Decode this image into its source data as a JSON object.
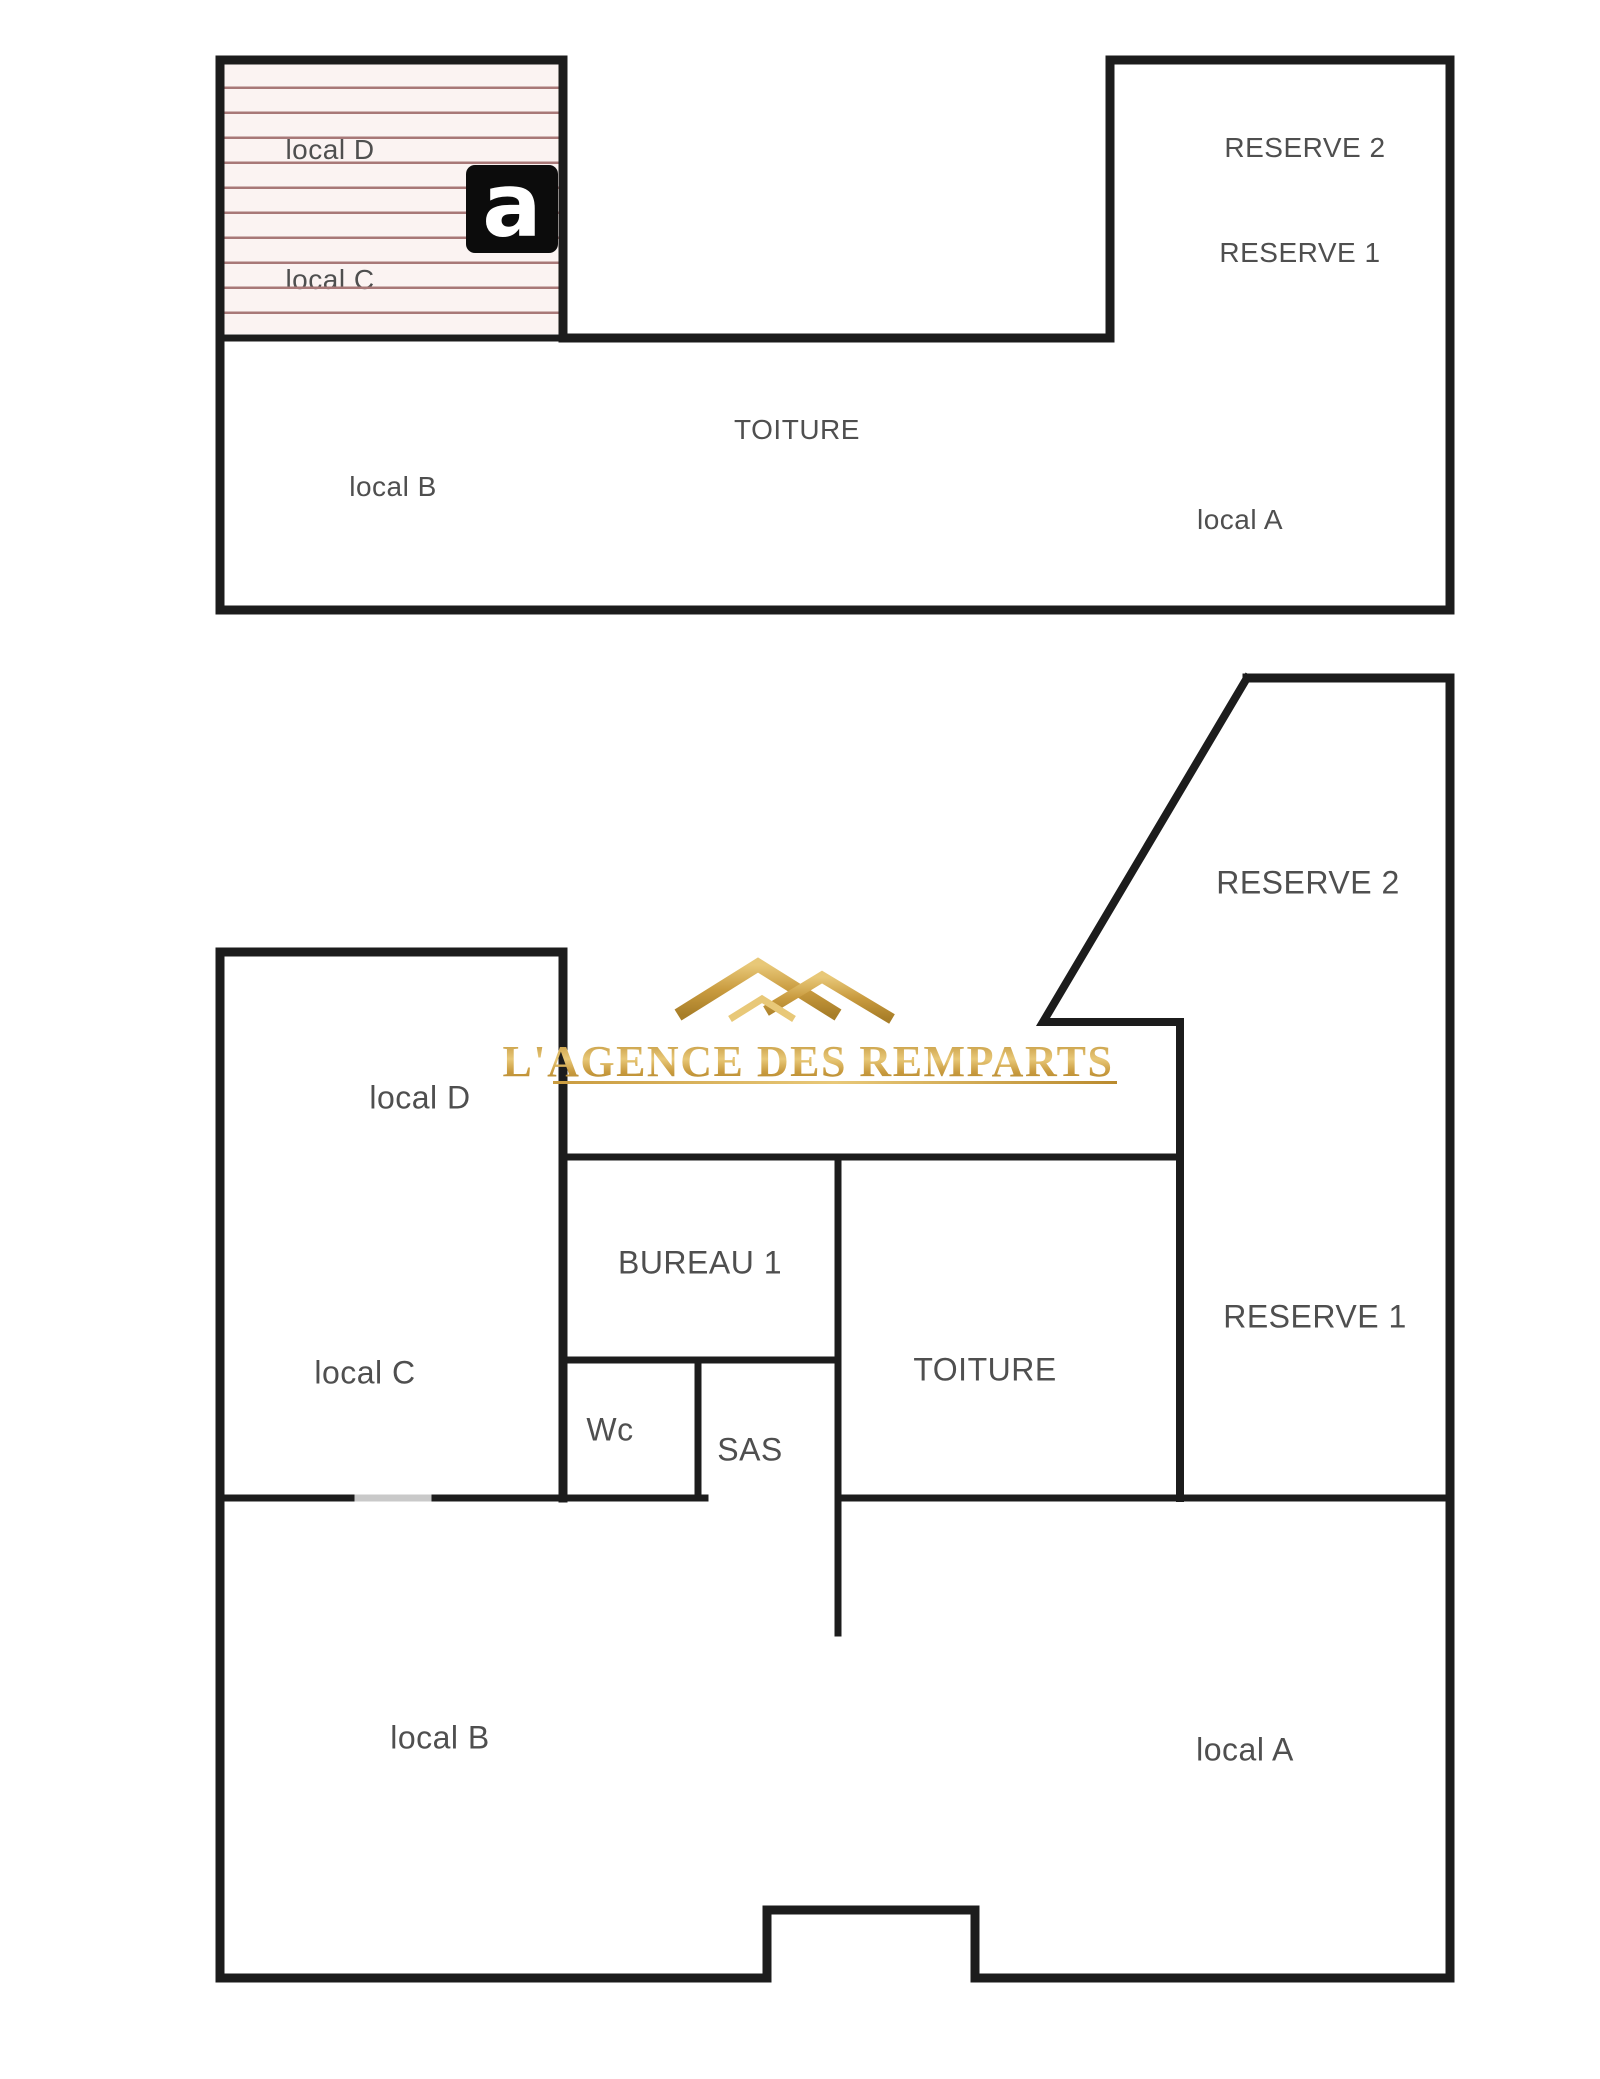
{
  "colors": {
    "wall": "#1c1c1c",
    "label_text": "#4f4f4f",
    "hatch_line": "#a87878",
    "hatch_background": "#fbf3f2",
    "door_gap": "#c9c9c9",
    "watermark_gold": "#c99b3f",
    "logo_background": "#0c0c0c",
    "logo_letter": "#ffffff"
  },
  "logo": {
    "letter": "a",
    "x": 466,
    "y": 165,
    "w": 92,
    "h": 88
  },
  "upper_plan": {
    "outline": {
      "points": [
        [
          220,
          60
        ],
        [
          563,
          60
        ],
        [
          563,
          338
        ],
        [
          1110,
          338
        ],
        [
          1110,
          60
        ],
        [
          1450,
          60
        ],
        [
          1450,
          610
        ],
        [
          220,
          610
        ],
        [
          220,
          60
        ]
      ],
      "w": 9
    },
    "inner_walls": [
      {
        "points": [
          [
            220,
            338
          ],
          [
            563,
            338
          ]
        ],
        "w": 7
      }
    ],
    "hatch_area": {
      "x": 224,
      "y": 64,
      "w": 335,
      "h": 270
    },
    "rooms": [
      {
        "id": "local-d",
        "label": "local D",
        "x": 330,
        "y": 150
      },
      {
        "id": "local-c",
        "label": "local C",
        "x": 330,
        "y": 280
      },
      {
        "id": "reserve-2",
        "label": "RESERVE 2",
        "x": 1305,
        "y": 148
      },
      {
        "id": "reserve-1",
        "label": "RESERVE 1",
        "x": 1300,
        "y": 253
      },
      {
        "id": "toiture",
        "label": "TOITURE",
        "x": 797,
        "y": 430
      },
      {
        "id": "local-b",
        "label": "local B",
        "x": 393,
        "y": 487
      },
      {
        "id": "local-a",
        "label": "local A",
        "x": 1240,
        "y": 520
      }
    ]
  },
  "lower_plan": {
    "walls": [
      {
        "points": [
          [
            1247,
            678
          ],
          [
            1450,
            678
          ],
          [
            1450,
            1978
          ],
          [
            975,
            1978
          ],
          [
            975,
            1910
          ],
          [
            767,
            1910
          ],
          [
            767,
            1978
          ],
          [
            220,
            1978
          ],
          [
            220,
            952
          ],
          [
            563,
            952
          ],
          [
            563,
            1498
          ]
        ],
        "w": 9
      },
      {
        "points": [
          [
            1247,
            678
          ],
          [
            1043,
            1022
          ],
          [
            1180,
            1022
          ],
          [
            1180,
            1498
          ]
        ],
        "w": 8
      },
      {
        "points": [
          [
            563,
            1157
          ],
          [
            1180,
            1157
          ]
        ],
        "w": 7
      },
      {
        "points": [
          [
            838,
            1157
          ],
          [
            838,
            1633
          ]
        ],
        "w": 7
      },
      {
        "points": [
          [
            563,
            1360
          ],
          [
            838,
            1360
          ]
        ],
        "w": 7
      },
      {
        "points": [
          [
            698,
            1360
          ],
          [
            698,
            1498
          ]
        ],
        "w": 7
      },
      {
        "points": [
          [
            220,
            1498
          ],
          [
            358,
            1498
          ]
        ],
        "w": 7
      },
      {
        "points": [
          [
            428,
            1498
          ],
          [
            705,
            1498
          ]
        ],
        "w": 7
      },
      {
        "points": [
          [
            838,
            1498
          ],
          [
            1450,
            1498
          ]
        ],
        "w": 7
      }
    ],
    "door_gaps": [
      {
        "points": [
          [
            358,
            1498
          ],
          [
            428,
            1498
          ]
        ],
        "w": 7
      }
    ],
    "rooms": [
      {
        "id": "local-d",
        "label": "local D",
        "x": 420,
        "y": 1098
      },
      {
        "id": "local-c",
        "label": "local C",
        "x": 365,
        "y": 1373
      },
      {
        "id": "bureau-1",
        "label": "BUREAU 1",
        "x": 700,
        "y": 1263
      },
      {
        "id": "wc",
        "label": "Wc",
        "x": 610,
        "y": 1430
      },
      {
        "id": "sas",
        "label": "SAS",
        "x": 750,
        "y": 1450
      },
      {
        "id": "toiture",
        "label": "TOITURE",
        "x": 985,
        "y": 1370
      },
      {
        "id": "reserve-2",
        "label": "RESERVE 2",
        "x": 1308,
        "y": 883
      },
      {
        "id": "reserve-1",
        "label": "RESERVE 1",
        "x": 1315,
        "y": 1317
      },
      {
        "id": "local-b",
        "label": "local B",
        "x": 440,
        "y": 1738
      },
      {
        "id": "local-a",
        "label": "local A",
        "x": 1245,
        "y": 1750
      }
    ]
  },
  "watermark": {
    "text": "L'AGENCE DES REMPARTS",
    "x": 808,
    "y": 1036,
    "underline": {
      "x1": 553,
      "x2": 1117,
      "y": 1081
    },
    "icon": {
      "cx": 785,
      "cy": 992
    }
  }
}
